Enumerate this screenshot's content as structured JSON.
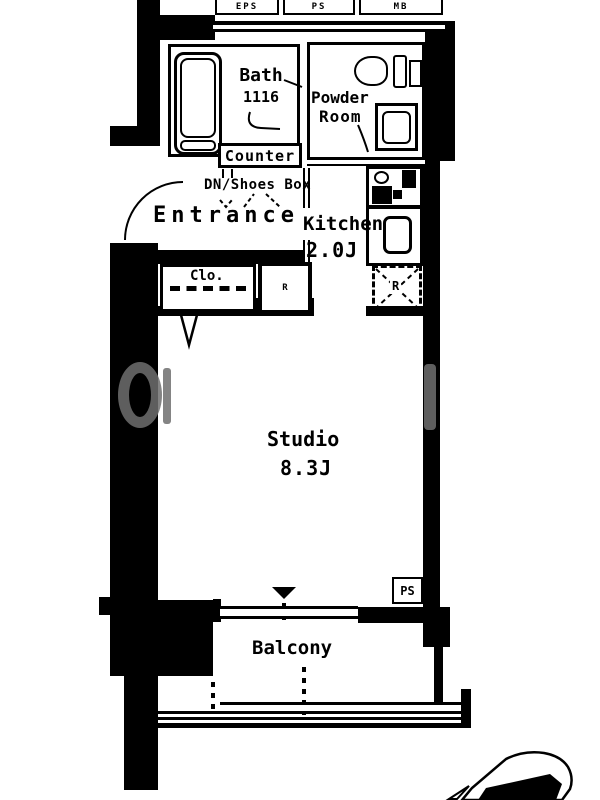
{
  "shafts": [
    {
      "label": "EPS"
    },
    {
      "label": "PS"
    },
    {
      "label": "MB"
    }
  ],
  "rooms": {
    "bath": {
      "name": "Bath",
      "size": "1116"
    },
    "powder_room": {
      "name_line1": "Powder",
      "name_line2": "Room"
    },
    "entrance": {
      "name": "Entrance",
      "counter_label": "Counter",
      "shoes_box_label": "DN/Shoes Box"
    },
    "kitchen": {
      "name": "Kitchen",
      "size": "2.0J",
      "refrigerator_label": "R"
    },
    "closet": {
      "label": "Clo."
    },
    "utility_box": {
      "label": "R"
    },
    "studio": {
      "name": "Studio",
      "size": "8.3J",
      "pipe_space_label": "PS"
    },
    "balcony": {
      "name": "Balcony"
    }
  },
  "colors": {
    "wall": "#000000",
    "background": "#ffffff",
    "watermark_gray": "#6f6f6f"
  }
}
